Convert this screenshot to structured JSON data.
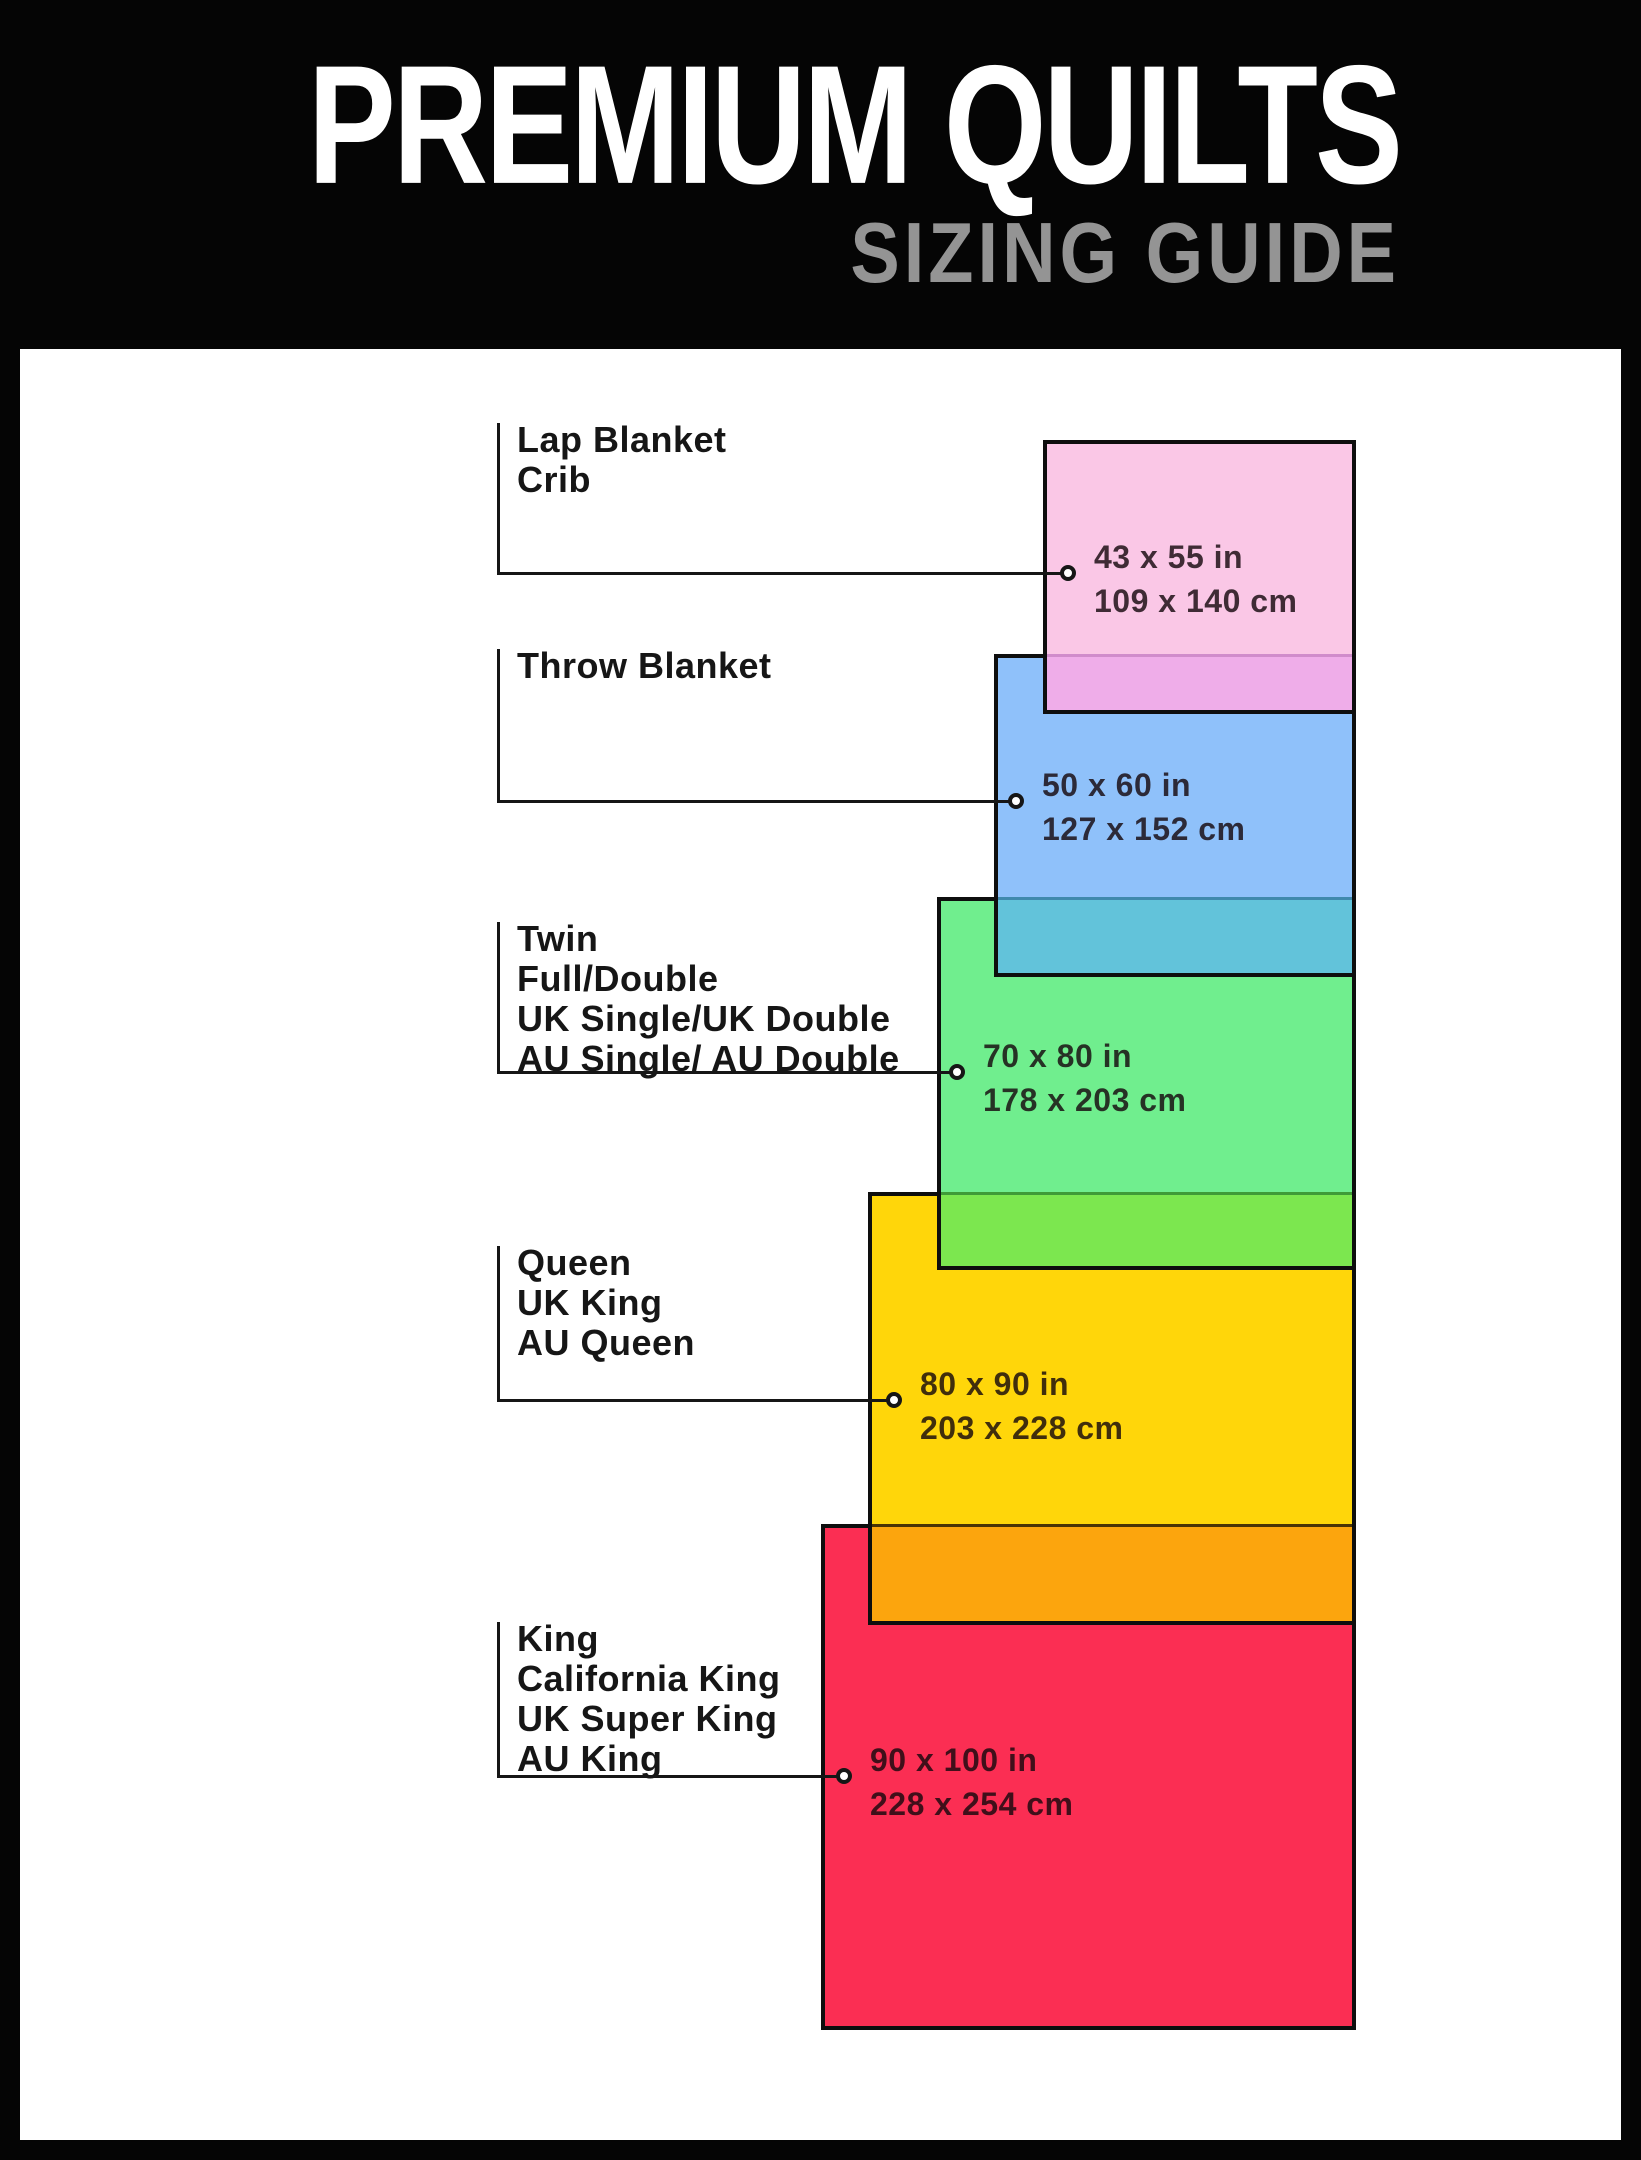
{
  "header": {
    "title": "PREMIUM QUILTS",
    "subtitle": "SIZING GUIDE",
    "title_color": "#ffffff",
    "subtitle_color": "#949494",
    "background": "#050505"
  },
  "panel": {
    "background": "#ffffff",
    "border_color": "#0e0e0e",
    "line_color": "#161616"
  },
  "sizes": [
    {
      "id": "lap-blanket-crib",
      "labels": [
        "Lap Blanket",
        "Crib"
      ],
      "inches": "43 x 55 in",
      "cm": "109 x 140 cm",
      "fill": "#fac7e6",
      "band": {
        "top": 654,
        "fill": "#efade9",
        "divider": "#d08ccb"
      },
      "rect": {
        "left": 1043,
        "top": 440,
        "width": 313,
        "height": 274
      },
      "label_top": 420,
      "conn_y": 573,
      "circle_x": 1068,
      "text_x": 1094
    },
    {
      "id": "throw-blanket",
      "labels": [
        "Throw Blanket"
      ],
      "inches": "50 x 60 in",
      "cm": "127 x 152 cm",
      "fill": "#8fc1fa",
      "band": {
        "top": 897,
        "fill": "#62c3da",
        "divider": "#3f89ad"
      },
      "rect": {
        "left": 994,
        "top": 654,
        "width": 362,
        "height": 323
      },
      "label_top": 646,
      "conn_y": 801,
      "circle_x": 1016,
      "text_x": 1042
    },
    {
      "id": "twin-full-double",
      "labels": [
        "Twin",
        "Full/Double",
        "UK Single/UK Double",
        "AU Single/ AU Double"
      ],
      "inches": "70 x 80 in",
      "cm": "178 x 203 cm",
      "fill": "#70ee8e",
      "band": {
        "top": 1192,
        "fill": "#7ce74f",
        "divider": "#3f9b37"
      },
      "rect": {
        "left": 937,
        "top": 897,
        "width": 419,
        "height": 373
      },
      "label_top": 919,
      "conn_y": 1072,
      "circle_x": 957,
      "text_x": 983
    },
    {
      "id": "queen",
      "labels": [
        "Queen",
        "UK King",
        "AU Queen"
      ],
      "inches": "80 x 90 in",
      "cm": "203 x 228 cm",
      "fill": "#ffd60a",
      "band": {
        "top": 1524,
        "fill": "#fca50d",
        "divider": "#4a3305"
      },
      "rect": {
        "left": 868,
        "top": 1192,
        "width": 488,
        "height": 433
      },
      "label_top": 1243,
      "conn_y": 1400,
      "circle_x": 894,
      "text_x": 920
    },
    {
      "id": "king",
      "labels": [
        "King",
        "California King",
        "UK Super King",
        "AU King"
      ],
      "inches": "90 x 100 in",
      "cm": "228 x 254 cm",
      "fill": "#fb2e53",
      "band": null,
      "rect": {
        "left": 821,
        "top": 1524,
        "width": 535,
        "height": 506
      },
      "label_top": 1619,
      "conn_y": 1776,
      "circle_x": 844,
      "text_x": 870
    }
  ],
  "layout_constants": {
    "label_x": 517,
    "vline_x": 497
  }
}
